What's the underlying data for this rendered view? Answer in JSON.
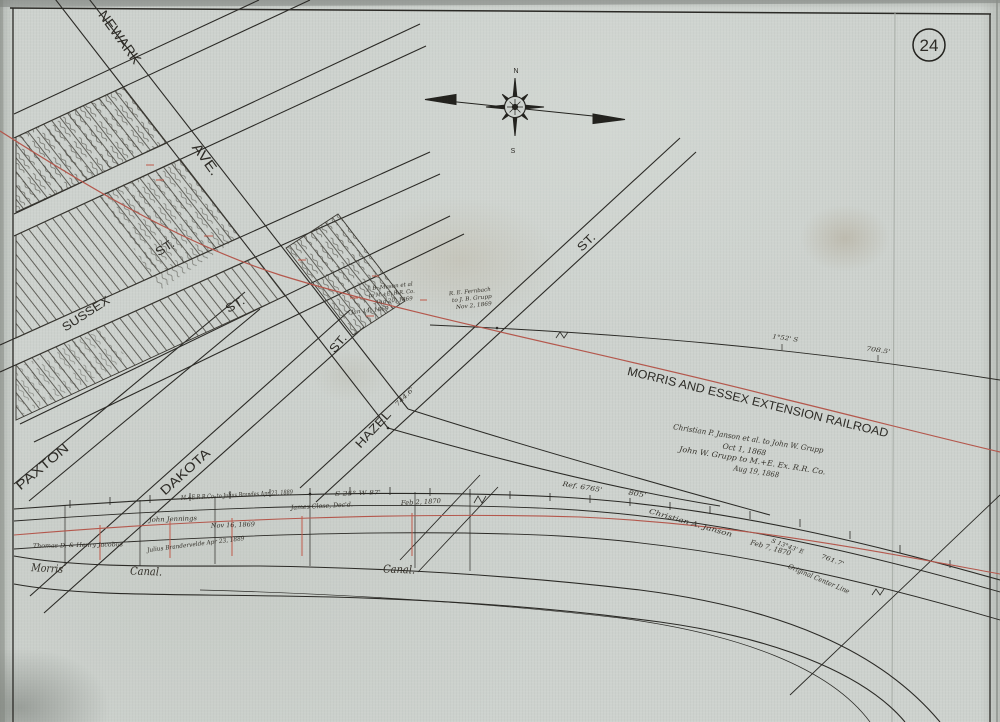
{
  "page": {
    "number": "24"
  },
  "colors": {
    "paper": "#cdd2ce",
    "ink": "#2b2a26",
    "red_line": "#b4574c",
    "red_bright": "#c05a4a"
  },
  "compass": {
    "north": {
      "name": "compass-north-label",
      "text": "N",
      "x": 516,
      "y": 73,
      "rot": 0,
      "size": 7
    },
    "south": {
      "name": "compass-south-label",
      "text": "S",
      "x": 513,
      "y": 153,
      "rot": 0,
      "size": 7
    }
  },
  "labels": {
    "streets": [
      {
        "name": "street-newark",
        "text": "NEWARK",
        "x": 116,
        "y": 40,
        "rot": 54,
        "size": 14,
        "tl": 62
      },
      {
        "name": "street-newark-ave",
        "text": "AVE.",
        "x": 202,
        "y": 162,
        "rot": 54,
        "size": 14,
        "tl": 36
      },
      {
        "name": "street-sussex",
        "text": "SUSSEX",
        "x": 88,
        "y": 317,
        "rot": -33,
        "size": 12,
        "tl": 54
      },
      {
        "name": "street-sussex-st",
        "text": "ST.",
        "x": 167,
        "y": 251,
        "rot": -33,
        "size": 12,
        "tl": 20
      },
      {
        "name": "street-st-2",
        "text": "ST.",
        "x": 237,
        "y": 308,
        "rot": -30,
        "size": 12,
        "tl": 20
      },
      {
        "name": "street-st-3",
        "text": "ST.",
        "x": 341,
        "y": 346,
        "rot": -50,
        "size": 12,
        "tl": 20
      },
      {
        "name": "street-hazel",
        "text": "HAZEL",
        "x": 376,
        "y": 432,
        "rot": -47,
        "size": 12,
        "tl": 46
      },
      {
        "name": "street-hazel-st",
        "text": "ST.",
        "x": 589,
        "y": 245,
        "rot": -44,
        "size": 12,
        "tl": 20
      },
      {
        "name": "street-paxton",
        "text": "PAXTON",
        "x": 45,
        "y": 470,
        "rot": -40,
        "size": 13,
        "tl": 64
      },
      {
        "name": "street-dakota",
        "text": "DAKOTA",
        "x": 188,
        "y": 475,
        "rot": -42,
        "size": 13,
        "tl": 62
      }
    ],
    "railroad": {
      "name": "railroad-name",
      "text": "MORRIS AND ESSEX EXTENSION RAILROAD",
      "x": 757,
      "y": 406,
      "rot": 13.5,
      "size": 12,
      "tl": 268
    },
    "canal": [
      {
        "name": "canal-label-morris",
        "text": "Morris",
        "x": 47,
        "y": 572,
        "rot": 3,
        "size": 11,
        "italic": true,
        "tl": 32
      },
      {
        "name": "canal-label-canal-1",
        "text": "Canal.",
        "x": 146,
        "y": 575,
        "rot": 2,
        "size": 11,
        "italic": true,
        "tl": 32
      },
      {
        "name": "canal-label-canal-2",
        "text": "Canal.",
        "x": 399,
        "y": 573,
        "rot": 2,
        "size": 11,
        "italic": true,
        "tl": 32
      }
    ],
    "deeds": [
      {
        "name": "janson-deed-line-1",
        "text": "Christian P. Janson et al.  to  John W. Grupp",
        "x": 748,
        "y": 441,
        "rot": 9,
        "size": 7.5,
        "italic": true,
        "tl": 152
      },
      {
        "name": "janson-deed-line-2",
        "text": "Oct 1, 1868",
        "x": 744,
        "y": 452,
        "rot": 9,
        "size": 7.5,
        "italic": true,
        "tl": 44
      },
      {
        "name": "janson-deed-line-3",
        "text": "John W. Grupp  to  M.+E. Ex. R.R. Co.",
        "x": 752,
        "y": 463,
        "rot": 9,
        "size": 7.5,
        "italic": true,
        "tl": 148
      },
      {
        "name": "janson-deed-line-4",
        "text": "Aug 19, 1868",
        "x": 756,
        "y": 474,
        "rot": 9,
        "size": 7.5,
        "italic": true,
        "tl": 46
      },
      {
        "name": "brandes-deed",
        "text": "M.+E.R.R.Co.  to Julius Brandes  Apr 23, 1889",
        "x": 237,
        "y": 497,
        "rot": -3,
        "size": 6.5,
        "italic": true,
        "tl": 112
      },
      {
        "name": "jennings",
        "text": "John Jennings",
        "x": 173,
        "y": 521,
        "rot": -2,
        "size": 6.5,
        "italic": true,
        "tl": 48
      },
      {
        "name": "jennings-date",
        "text": "Nov 16, 1869",
        "x": 233,
        "y": 527,
        "rot": -2,
        "size": 6.5,
        "italic": true,
        "tl": 44
      },
      {
        "name": "close",
        "text": "James Close, Dec'd.",
        "x": 322,
        "y": 508,
        "rot": -3,
        "size": 6.5,
        "italic": true,
        "tl": 62
      },
      {
        "name": "close-date",
        "text": "Feb 2, 1870",
        "x": 421,
        "y": 504,
        "rot": -3,
        "size": 6.5,
        "italic": true,
        "tl": 40
      },
      {
        "name": "jacobus",
        "text": "Thomas D. & Henry Jacobus",
        "x": 78,
        "y": 547,
        "rot": -1,
        "size": 6,
        "italic": true,
        "tl": 90
      },
      {
        "name": "brandervelde",
        "text": "Julius Brandervelde  Apr 23, 1889",
        "x": 196,
        "y": 546,
        "rot": -7,
        "size": 6,
        "italic": true,
        "tl": 98
      },
      {
        "name": "janson-canal",
        "text": "Christian A. Janson",
        "x": 690,
        "y": 525,
        "rot": 16,
        "size": 7,
        "italic": true,
        "tl": 86
      },
      {
        "name": "janson-canal-date",
        "text": "Feb 7, 1870",
        "x": 770,
        "y": 550,
        "rot": 16,
        "size": 7,
        "italic": true,
        "tl": 42
      },
      {
        "name": "original-center-line",
        "text": "Original Center Line",
        "x": 818,
        "y": 581,
        "rot": 23,
        "size": 7,
        "italic": true,
        "tl": 66
      },
      {
        "name": "mason-deed-line-1",
        "text": "J. B. Mason et al",
        "x": 390,
        "y": 288,
        "rot": -6,
        "size": 5.5,
        "italic": true,
        "tl": 46
      },
      {
        "name": "mason-deed-line-2",
        "text": "to M.+E. R.R. Co.",
        "x": 392,
        "y": 295,
        "rot": -6,
        "size": 5.5,
        "italic": true,
        "tl": 46
      },
      {
        "name": "mason-deed-line-3",
        "text": "Aug 20, 1869",
        "x": 394,
        "y": 302,
        "rot": -6,
        "size": 5.5,
        "italic": true,
        "tl": 38
      },
      {
        "name": "fernbach-deed-line-1",
        "text": "R. E. Fernbach",
        "x": 470,
        "y": 293,
        "rot": -6,
        "size": 5.5,
        "italic": true,
        "tl": 42
      },
      {
        "name": "fernbach-deed-line-2",
        "text": "to J. B. Grupp",
        "x": 472,
        "y": 300,
        "rot": -6,
        "size": 5.5,
        "italic": true,
        "tl": 40
      },
      {
        "name": "fernbach-deed-line-3",
        "text": "Nov 2, 1869",
        "x": 474,
        "y": 307,
        "rot": -6,
        "size": 5.5,
        "italic": true,
        "tl": 36
      },
      {
        "name": "grupp-date",
        "text": "Jan 14, 1869",
        "x": 370,
        "y": 312,
        "rot": -6,
        "size": 5.5,
        "italic": true,
        "tl": 38
      }
    ],
    "measurements": [
      {
        "name": "meas-ref-6765",
        "text": "Ref. 6765'",
        "x": 582,
        "y": 489,
        "rot": 9,
        "size": 6.5,
        "italic": true,
        "tl": 40
      },
      {
        "name": "meas-805",
        "text": "805'",
        "x": 637,
        "y": 496,
        "rot": 9,
        "size": 6.5,
        "italic": true,
        "tl": 18
      },
      {
        "name": "meas-708-5",
        "text": "708.5'",
        "x": 878,
        "y": 352,
        "rot": 8,
        "size": 6,
        "italic": true,
        "tl": 24
      },
      {
        "name": "meas-1-52",
        "text": "1°52' S",
        "x": 785,
        "y": 340,
        "rot": 8,
        "size": 6,
        "italic": true,
        "tl": 26
      },
      {
        "name": "meas-s13-43e",
        "text": "S 13°43' E",
        "x": 787,
        "y": 548,
        "rot": 20,
        "size": 6,
        "italic": true,
        "tl": 34
      },
      {
        "name": "meas-761-7",
        "text": "761.7'",
        "x": 832,
        "y": 562,
        "rot": 20,
        "size": 6,
        "italic": true,
        "tl": 24
      },
      {
        "name": "meas-s25w",
        "text": "S 25° W   87'",
        "x": 358,
        "y": 495,
        "rot": -2,
        "size": 6,
        "italic": true,
        "tl": 46
      },
      {
        "name": "meas-744-6",
        "text": "744.6'",
        "x": 406,
        "y": 398,
        "rot": -45,
        "size": 6,
        "italic": true,
        "tl": 24
      }
    ]
  }
}
